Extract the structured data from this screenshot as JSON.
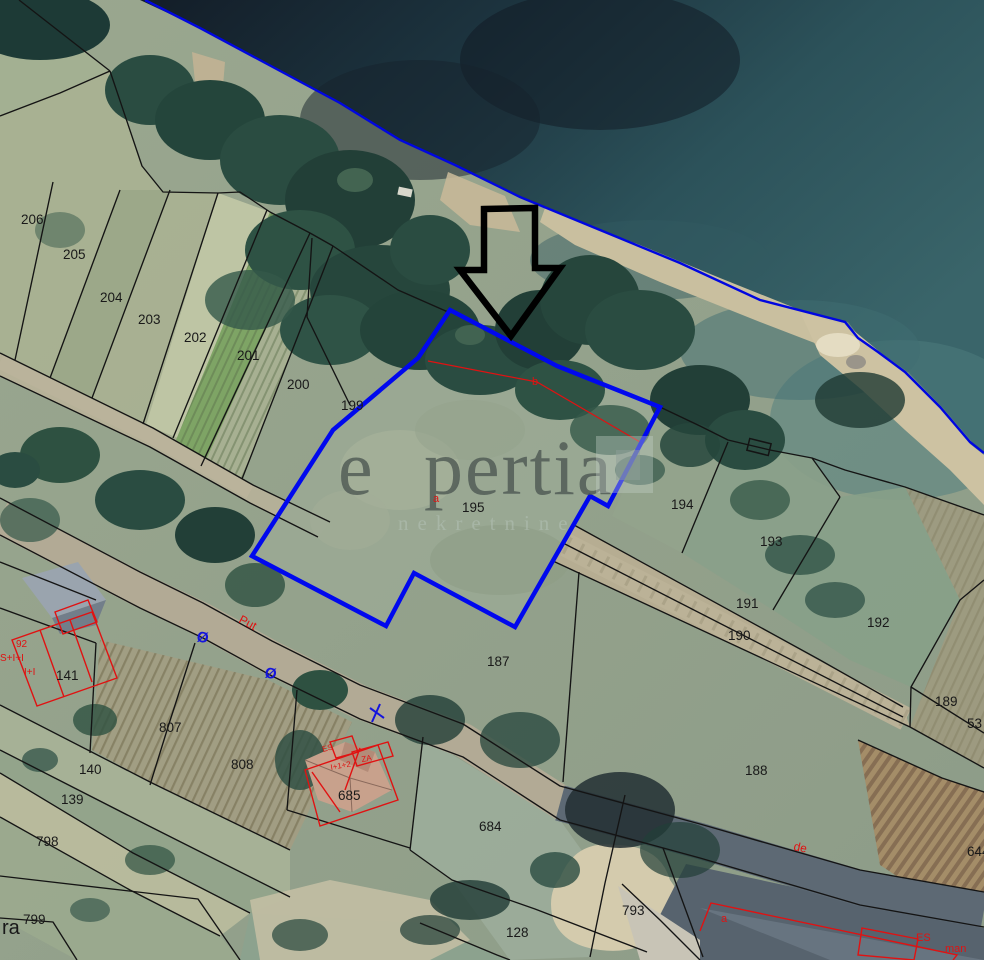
{
  "watermark": {
    "word_start": "e",
    "word_end": "pertia",
    "tagline": "nekretnine"
  },
  "map_overlay": {
    "highlight_color": "#0008ee",
    "coastline_color": "#0006e0",
    "boundary_color": "#141414",
    "annotation_color": "#e01212",
    "parcel_labels": [
      {
        "text": "206",
        "x": 21,
        "y": 224
      },
      {
        "text": "205",
        "x": 63,
        "y": 259
      },
      {
        "text": "204",
        "x": 100,
        "y": 302
      },
      {
        "text": "203",
        "x": 138,
        "y": 324
      },
      {
        "text": "202",
        "x": 184,
        "y": 342
      },
      {
        "text": "201",
        "x": 237,
        "y": 360
      },
      {
        "text": "200",
        "x": 287,
        "y": 389
      },
      {
        "text": "199",
        "x": 341,
        "y": 410
      },
      {
        "text": "195",
        "x": 462,
        "y": 512
      },
      {
        "text": "194",
        "x": 671,
        "y": 509
      },
      {
        "text": "193",
        "x": 760,
        "y": 546
      },
      {
        "text": "192",
        "x": 867,
        "y": 627
      },
      {
        "text": "191",
        "x": 736,
        "y": 608
      },
      {
        "text": "190",
        "x": 728,
        "y": 640
      },
      {
        "text": "189",
        "x": 935,
        "y": 706
      },
      {
        "text": "53",
        "x": 967,
        "y": 728
      },
      {
        "text": "187",
        "x": 487,
        "y": 666
      },
      {
        "text": "188",
        "x": 745,
        "y": 775
      },
      {
        "text": "807",
        "x": 159,
        "y": 732
      },
      {
        "text": "808",
        "x": 231,
        "y": 769
      },
      {
        "text": "141",
        "x": 56,
        "y": 680
      },
      {
        "text": "140",
        "x": 79,
        "y": 774
      },
      {
        "text": "139",
        "x": 61,
        "y": 804
      },
      {
        "text": "798",
        "x": 36,
        "y": 846
      },
      {
        "text": "799",
        "x": 23,
        "y": 924
      },
      {
        "text": "685",
        "x": 338,
        "y": 800
      },
      {
        "text": "684",
        "x": 479,
        "y": 831
      },
      {
        "text": "128",
        "x": 506,
        "y": 937
      },
      {
        "text": "793",
        "x": 622,
        "y": 915
      },
      {
        "text": "644",
        "x": 967,
        "y": 856
      },
      {
        "text": "ra",
        "x": 2,
        "y": 934,
        "size": 20
      }
    ],
    "red_labels": [
      {
        "text": "Put",
        "x": 238,
        "y": 622,
        "rot": 28,
        "size": 12
      },
      {
        "text": "de",
        "x": 793,
        "y": 850,
        "rot": 12,
        "size": 12
      },
      {
        "text": "a",
        "x": 433,
        "y": 502,
        "size": 11
      },
      {
        "text": "b",
        "x": 532,
        "y": 385,
        "size": 11
      },
      {
        "text": "a",
        "x": 721,
        "y": 922,
        "size": 11
      },
      {
        "text": "92",
        "x": 16,
        "y": 647,
        "size": 10
      },
      {
        "text": "S+I+I",
        "x": 0,
        "y": 661,
        "size": 10
      },
      {
        "text": "I+I",
        "x": 24,
        "y": 675,
        "size": 10
      },
      {
        "text": "ES",
        "x": 323,
        "y": 752,
        "rot": -15,
        "size": 8
      },
      {
        "text": "I+1+2",
        "x": 331,
        "y": 770,
        "rot": -10,
        "size": 8
      },
      {
        "text": "ZA",
        "x": 362,
        "y": 762,
        "rot": -10,
        "size": 8
      },
      {
        "text": "ES",
        "x": 916,
        "y": 941,
        "size": 11
      },
      {
        "text": "man",
        "x": 945,
        "y": 952,
        "size": 11
      }
    ],
    "blue_marks": [
      {
        "text": "Ø",
        "x": 196,
        "y": 641,
        "rot": 12,
        "size": 15
      },
      {
        "text": "Ø",
        "x": 264,
        "y": 677,
        "rot": 12,
        "size": 15
      }
    ]
  }
}
